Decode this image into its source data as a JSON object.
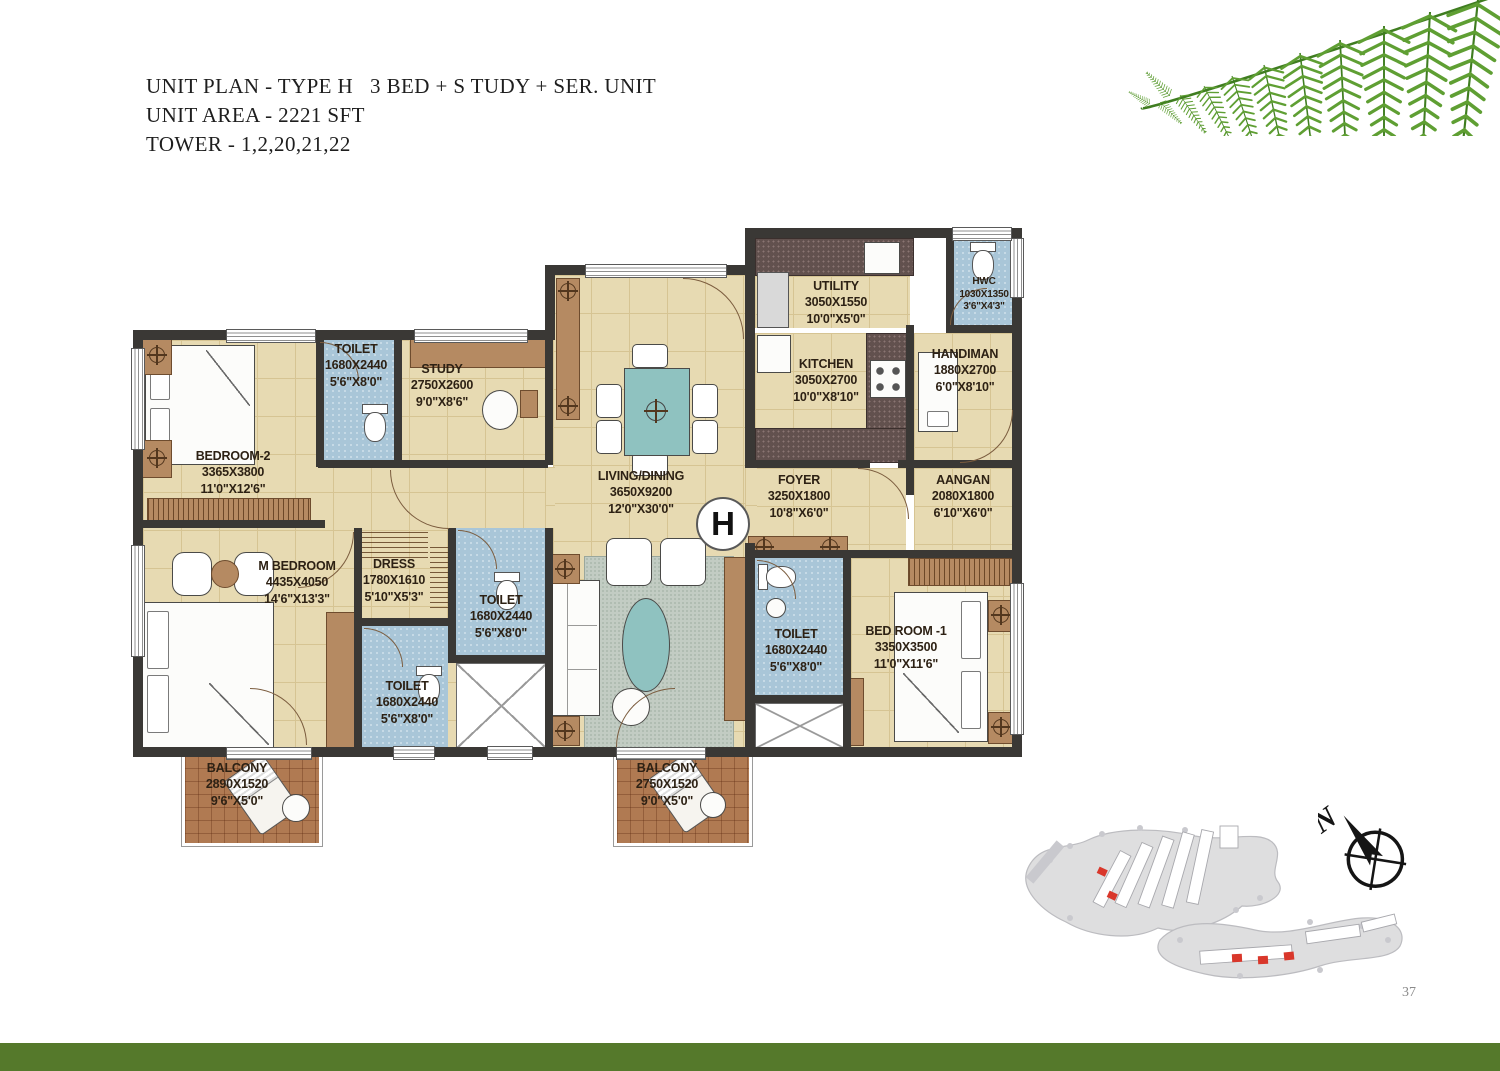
{
  "header": {
    "line1": "UNIT PLAN - TYPE H   3 BED + S TUDY + SER. UNIT",
    "line2": "UNIT AREA - 2221 SFT",
    "line3": "TOWER - 1,2,20,21,22"
  },
  "unit_marker": "H",
  "rooms": {
    "bedroom2": {
      "name": "BEDROOM-2",
      "dims_mm": "3365X3800",
      "dims_ft": "11'0\"X12'6\""
    },
    "toilet_top": {
      "name": "TOILET",
      "dims_mm": "1680X2440",
      "dims_ft": "5'6\"X8'0\""
    },
    "study": {
      "name": "STUDY",
      "dims_mm": "2750X2600",
      "dims_ft": "9'0\"X8'6\""
    },
    "living_dining": {
      "name": "LIVING/DINING",
      "dims_mm": "3650X9200",
      "dims_ft": "12'0\"X30'0\""
    },
    "utility": {
      "name": "UTILITY",
      "dims_mm": "3050X1550",
      "dims_ft": "10'0\"X5'0\""
    },
    "hwc": {
      "name": "HWC",
      "dims_mm": "1030X1350",
      "dims_ft": "3'6\"X4'3\""
    },
    "kitchen": {
      "name": "KITCHEN",
      "dims_mm": "3050X2700",
      "dims_ft": "10'0\"X8'10\""
    },
    "handiman": {
      "name": "HANDIMAN",
      "dims_mm": "1880X2700",
      "dims_ft": "6'0\"X8'10\""
    },
    "foyer": {
      "name": "FOYER",
      "dims_mm": "3250X1800",
      "dims_ft": "10'8\"X6'0\""
    },
    "aangan": {
      "name": "AANGAN",
      "dims_mm": "2080X1800",
      "dims_ft": "6'10\"X6'0\""
    },
    "m_bedroom": {
      "name": "M BEDROOM",
      "dims_mm": "4435X4050",
      "dims_ft": "14'6\"X13'3\""
    },
    "dress": {
      "name": "DRESS",
      "dims_mm": "1780X1610",
      "dims_ft": "5'10\"X5'3\""
    },
    "toilet_mid": {
      "name": "TOILET",
      "dims_mm": "1680X2440",
      "dims_ft": "5'6\"X8'0\""
    },
    "toilet_lower": {
      "name": "TOILET",
      "dims_mm": "1680X2440",
      "dims_ft": "5'6\"X8'0\""
    },
    "toilet_right": {
      "name": "TOILET",
      "dims_mm": "1680X2440",
      "dims_ft": "5'6\"X8'0\""
    },
    "bedroom1": {
      "name": "BED ROOM -1",
      "dims_mm": "3350X3500",
      "dims_ft": "11'0\"X11'6\""
    },
    "balcony_left": {
      "name": "BALCONY",
      "dims_mm": "2890X1520",
      "dims_ft": "9'6\"X5'0\""
    },
    "balcony_mid": {
      "name": "BALCONY",
      "dims_mm": "2750X1520",
      "dims_ft": "9'0\"X5'0\""
    }
  },
  "compass": {
    "label": "N"
  },
  "page_number": "37",
  "colors": {
    "floor_beige": "#e7dab2",
    "toilet_blue": "#a9c6d8",
    "balcony_brick": "#b07a52",
    "wall_dark": "#3a3835",
    "wood_brown": "#b58a62",
    "table_teal": "#8fc2c0",
    "footer_green": "#55792b",
    "fern_green": "#5f9f33",
    "site_highlight_red": "#d9372b"
  }
}
